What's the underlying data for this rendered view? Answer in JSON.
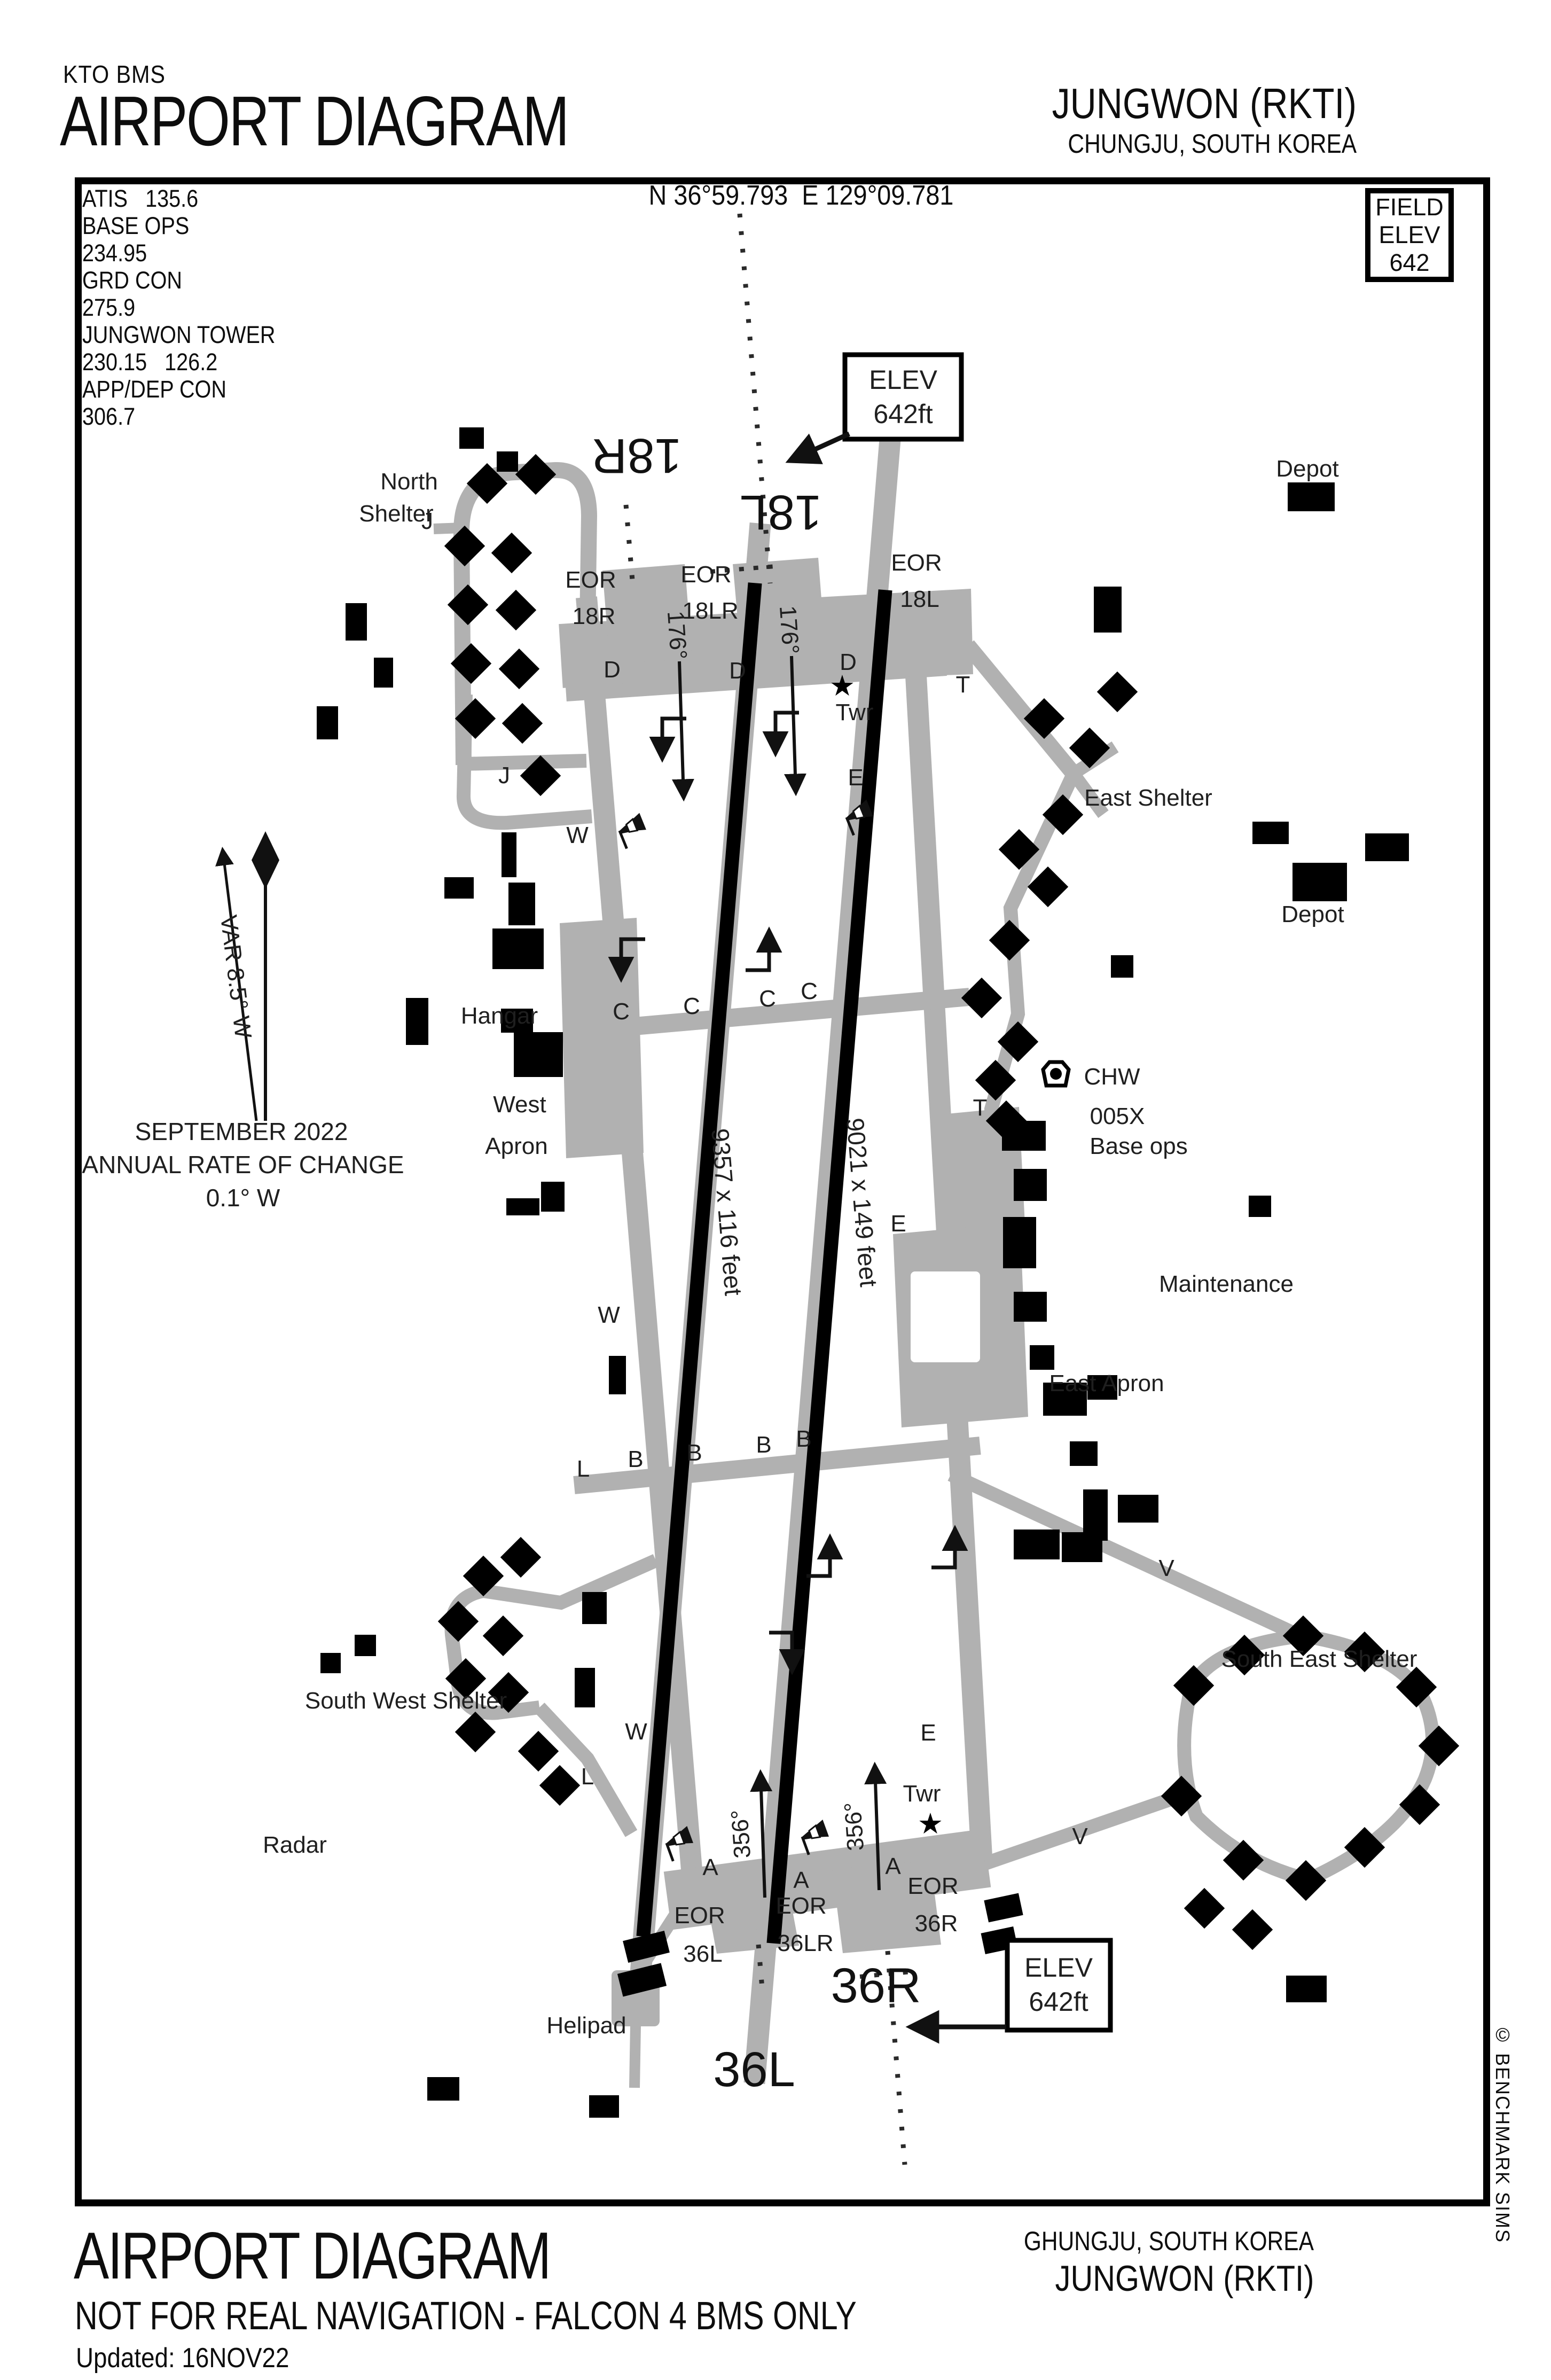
{
  "header": {
    "kicker": "KTO BMS",
    "title": "AIRPORT DIAGRAM",
    "airport": "JUNGWON (RKTI)",
    "location": "CHUNGJU, SOUTH KOREA"
  },
  "info_bar": {
    "frequencies": [
      "ATIS   135.6",
      "BASE OPS",
      "234.95",
      "GRD CON",
      "275.9",
      "JUNGWON TOWER",
      "230.15   126.2",
      "APP/DEP CON",
      "306.7"
    ],
    "coordinates": "N 36°59.793  E 129°09.781",
    "field_elev": [
      "FIELD",
      "ELEV",
      "642"
    ]
  },
  "variation": {
    "arrow_label": "VAR 8.5° W",
    "date": "SEPTEMBER 2022",
    "note": "ANNUAL RATE OF CHANGE",
    "rate": "0.1° W"
  },
  "elev_callout": {
    "line1": "ELEV",
    "line2": "642ft"
  },
  "runways": {
    "west": {
      "north_id": "18R",
      "south_id": "36L",
      "dimensions": "9357 x 116 feet",
      "heading_south": "176°",
      "heading_north": "356°"
    },
    "east": {
      "north_id": "18L",
      "south_id": "36R",
      "dimensions": "9021 x 149 feet",
      "heading_south": "176°",
      "heading_north": "356°"
    }
  },
  "eor": {
    "top_west": [
      "EOR",
      "18R"
    ],
    "top_center": [
      "EOR",
      "18LR"
    ],
    "top_east": [
      "EOR",
      "18L"
    ],
    "bottom_west": [
      "EOR",
      "36L"
    ],
    "bottom_center": [
      "EOR",
      "36LR"
    ],
    "bottom_east": [
      "EOR",
      "36R"
    ]
  },
  "facilities": {
    "north_shelter_line1": "North",
    "north_shelter_line2": "Shelter",
    "east_shelter": "East Shelter",
    "depot": "Depot",
    "hangar": "Hangar",
    "west_apron_line1": "West",
    "west_apron_line2": "Apron",
    "tacan_id": "CHW",
    "tacan_channel": "005X",
    "base_ops": "Base ops",
    "maintenance": "Maintenance",
    "east_apron": "East Apron",
    "south_west_shelter": "South West Shelter",
    "radar": "Radar",
    "helipad": "Helipad",
    "south_east_shelter": "South East Shelter",
    "tower": "Twr"
  },
  "taxiways": {
    "a": "A",
    "b": "B",
    "c": "C",
    "d": "D",
    "e": "E",
    "j": "J",
    "l": "L",
    "t": "T",
    "v": "V",
    "w": "W"
  },
  "icons": {
    "tower_star": "★"
  },
  "footer": {
    "title": "AIRPORT DIAGRAM",
    "warning": "NOT FOR REAL NAVIGATION - FALCON 4 BMS ONLY",
    "updated": "Updated: 16NOV22",
    "location": "GHUNGJU, SOUTH KOREA",
    "airport": "JUNGWON (RKTI)"
  },
  "credit": "© BENCHMARK SIMS",
  "colors": {
    "paper": "#ffffff",
    "ink": "#000000",
    "taxiway": "#b1b1b1"
  }
}
